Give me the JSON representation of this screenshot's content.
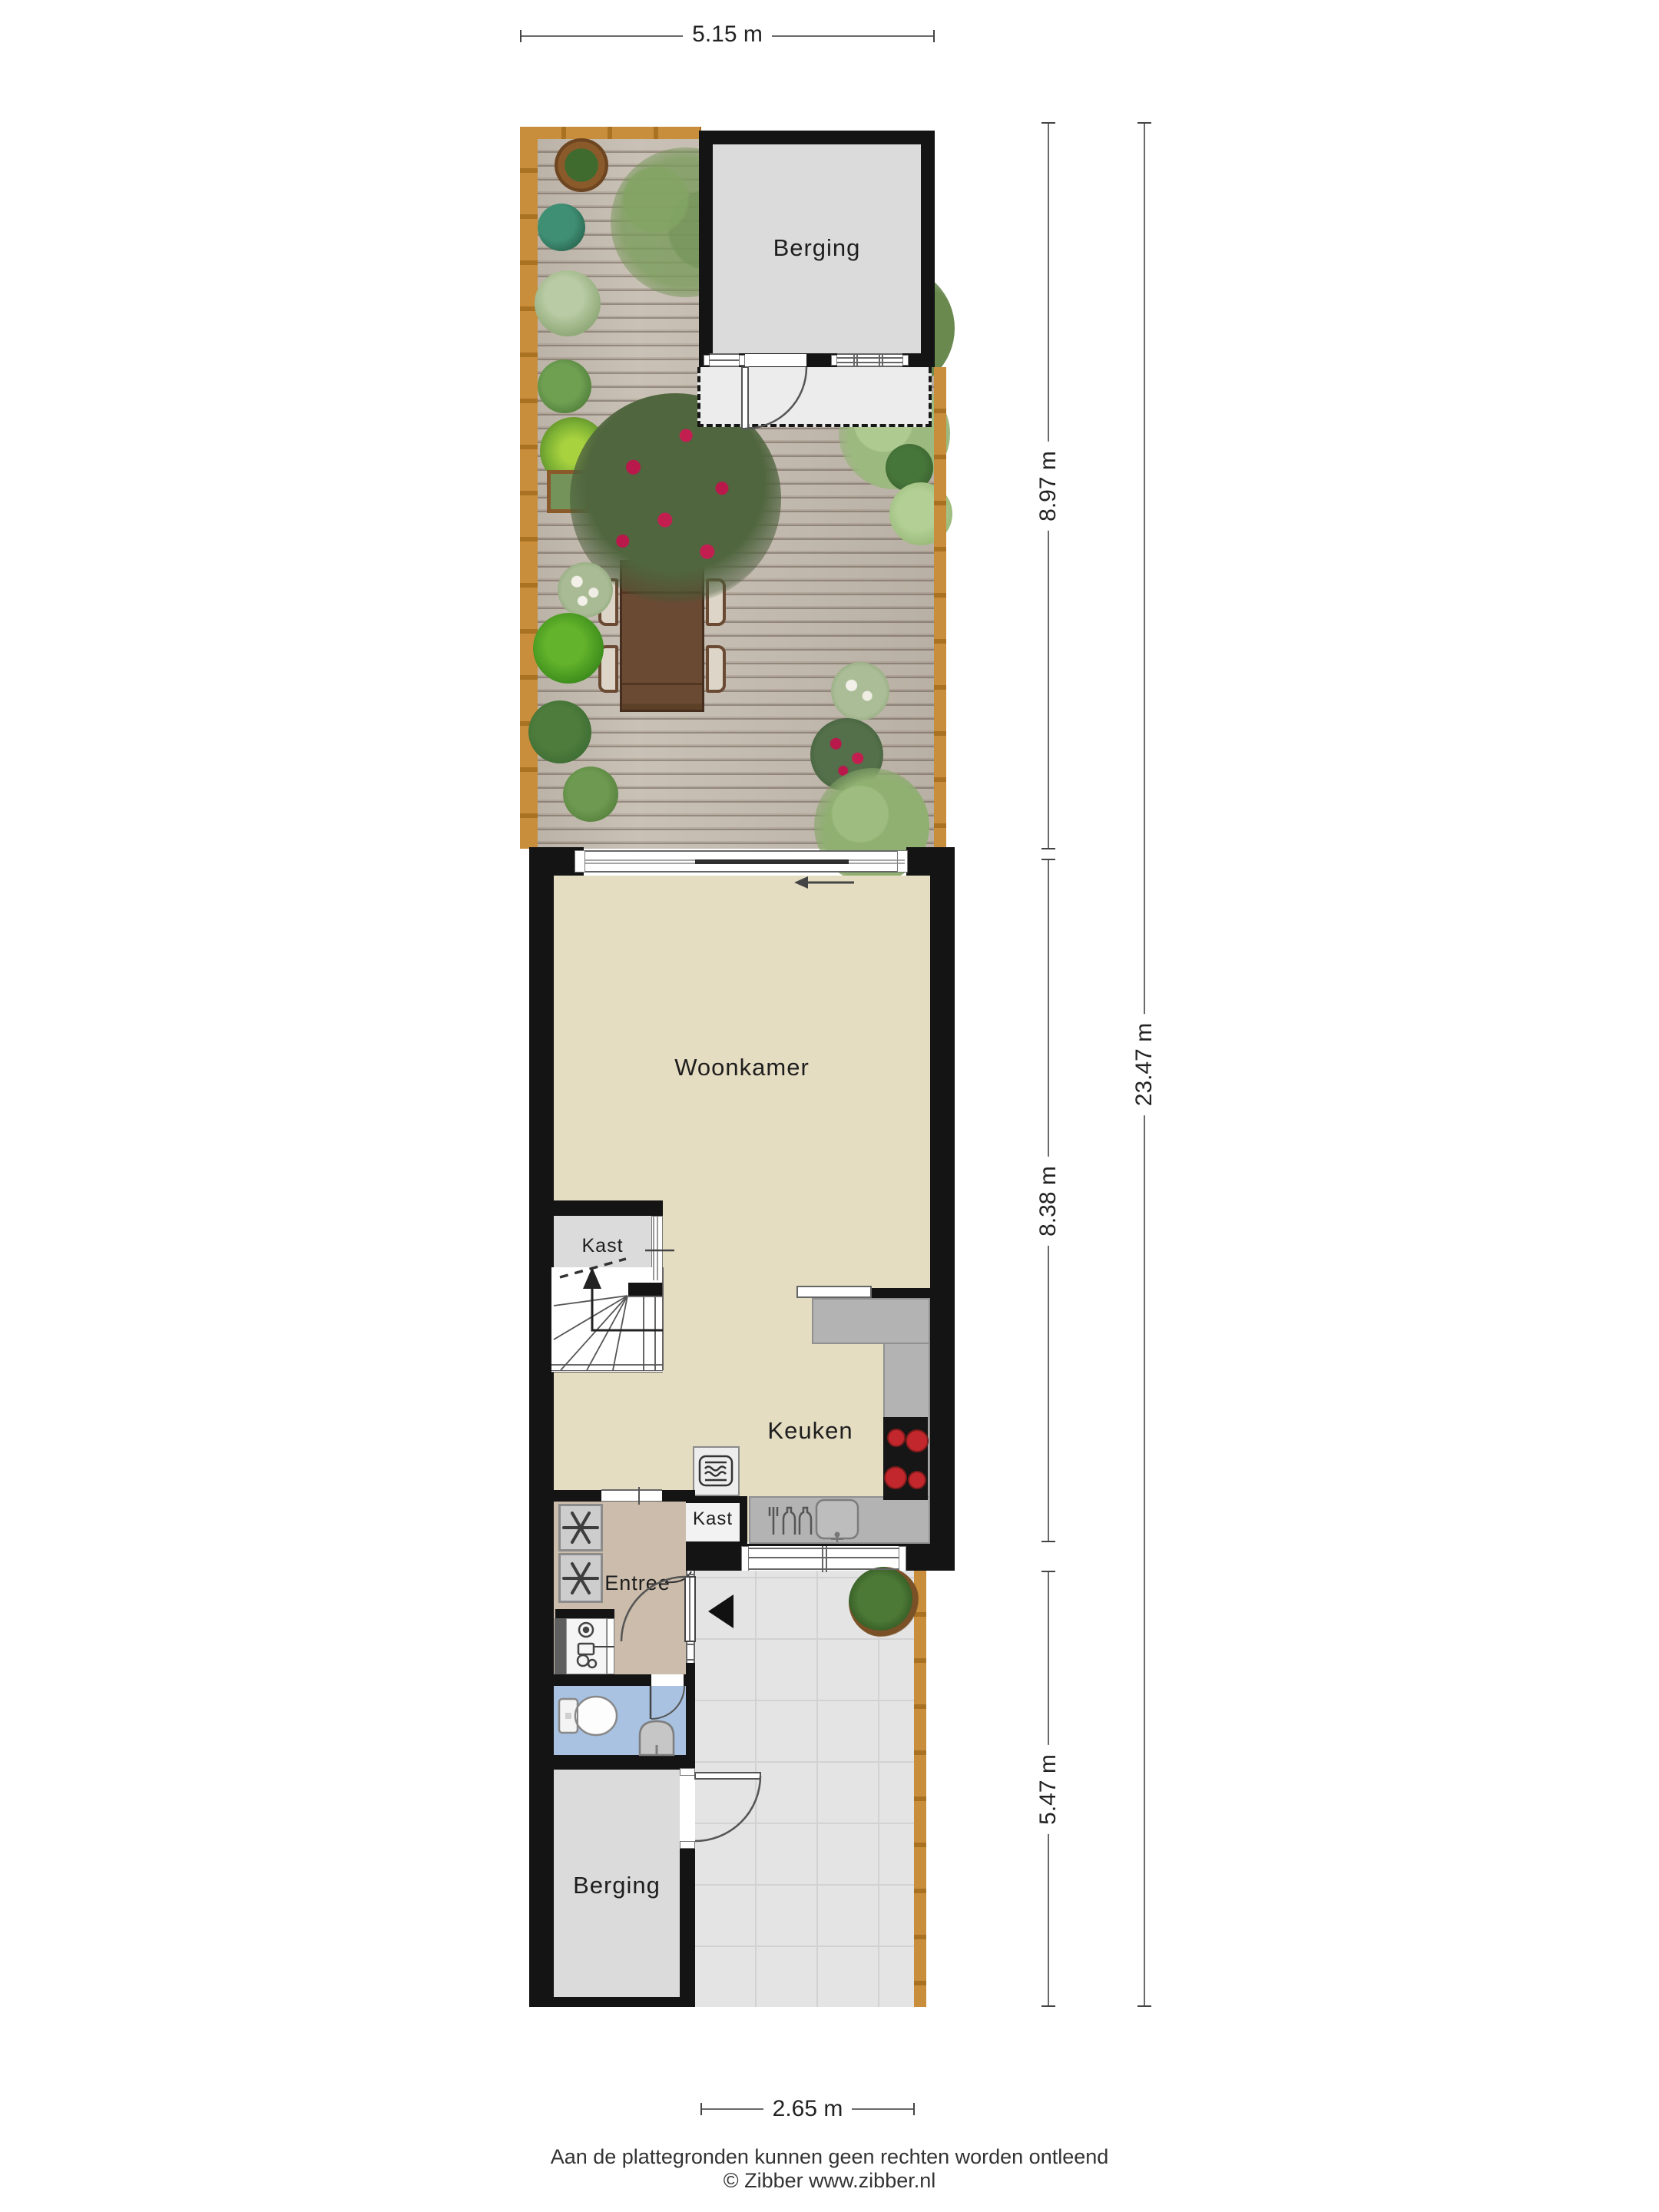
{
  "labels": {
    "berging_top": "Berging",
    "woonkamer": "Woonkamer",
    "kast_upper": "Kast",
    "keuken": "Keuken",
    "kast_lower": "Kast",
    "entree": "Entree",
    "berging_bottom": "Berging"
  },
  "dimensions": {
    "top_width": "5.15 m",
    "garden_depth": "8.97 m",
    "house_depth": "8.38 m",
    "patio_depth": "5.47 m",
    "total_depth": "23.47 m",
    "bottom_width": "2.65 m"
  },
  "footer": {
    "disclaimer": "Aan de plattegronden kunnen geen rechten worden ontleend",
    "credit": "© Zibber www.zibber.nl"
  },
  "icons": {
    "washer_icons": "washing-machine-fan-icon",
    "microwave": "microwave-icon",
    "cooktop": "cooktop-4-burner-icon",
    "sink": "kitchen-sink-icon",
    "dishwasher": "dishwasher-bottles-icon",
    "toilet": "toilet-icon",
    "washbasin": "washbasin-icon",
    "boiler": "boiler-meter-icon",
    "stairs_arrow": "stairs-up-arrow",
    "sliding_door_arrow": "sliding-door-arrow",
    "entrance_arrow": "entrance-direction-arrow"
  },
  "colors": {
    "wall": "#141414",
    "floor_living": "#e5ddc2",
    "floor_entree": "#cbbcab",
    "floor_bath": "#a9c2e2",
    "floor_storage": "#dbdbdb",
    "patio": "#e4e4e4",
    "deck": "#bdb2a6",
    "fence": "#c08433",
    "counter": "#b3b3b3",
    "burner": "#c1272d"
  }
}
